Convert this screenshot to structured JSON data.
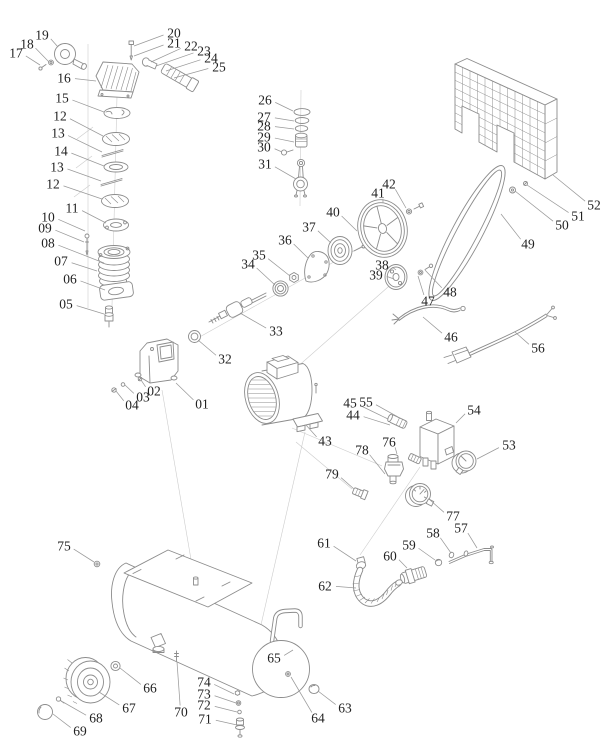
{
  "canvas": {
    "width": 615,
    "height": 755,
    "background": "#ffffff",
    "line_color": "#8c8c8c",
    "faint_line_color": "#cccccc",
    "leader_color": "#9a9a9a",
    "label_color": "#222222"
  },
  "diagram": {
    "type": "exploded-parts-diagram",
    "labels": [
      {
        "t": "01",
        "x": 202,
        "y": 404,
        "tx": 176,
        "ty": 383
      },
      {
        "t": "02",
        "x": 154,
        "y": 391,
        "tx": 141,
        "ty": 380
      },
      {
        "t": "03",
        "x": 143,
        "y": 397,
        "tx": 125,
        "ty": 385
      },
      {
        "t": "04",
        "x": 132,
        "y": 405,
        "tx": 116,
        "ty": 391
      },
      {
        "t": "05",
        "x": 66,
        "y": 304,
        "tx": 104,
        "ty": 314
      },
      {
        "t": "06",
        "x": 70,
        "y": 279,
        "tx": 105,
        "ty": 290
      },
      {
        "t": "07",
        "x": 61,
        "y": 261,
        "tx": 97,
        "ty": 271
      },
      {
        "t": "08",
        "x": 48,
        "y": 243,
        "tx": 104,
        "ty": 263
      },
      {
        "t": "09",
        "x": 45,
        "y": 228,
        "tx": 84,
        "ty": 242
      },
      {
        "t": "10",
        "x": 48,
        "y": 217,
        "tx": 85,
        "ty": 231
      },
      {
        "t": "11",
        "x": 72,
        "y": 208,
        "tx": 106,
        "ty": 223
      },
      {
        "t": "12",
        "x": 60,
        "y": 116,
        "tx": 103,
        "ty": 136
      },
      {
        "t": "13",
        "x": 58,
        "y": 133,
        "tx": 102,
        "ty": 152
      },
      {
        "t": "14",
        "x": 61,
        "y": 151,
        "tx": 104,
        "ty": 166
      },
      {
        "t": "13",
        "x": 57,
        "y": 167,
        "tx": 101,
        "ty": 181
      },
      {
        "t": "12",
        "x": 53,
        "y": 184,
        "tx": 102,
        "ty": 199
      },
      {
        "t": "15",
        "x": 62,
        "y": 98,
        "tx": 104,
        "ty": 112
      },
      {
        "t": "16",
        "x": 64,
        "y": 78,
        "tx": 96,
        "ty": 81
      },
      {
        "t": "17",
        "x": 16,
        "y": 53,
        "tx": 40,
        "ty": 65
      },
      {
        "t": "18",
        "x": 27,
        "y": 44,
        "tx": 49,
        "ty": 62
      },
      {
        "t": "19",
        "x": 42,
        "y": 35,
        "tx": 58,
        "ty": 47
      },
      {
        "t": "20",
        "x": 174,
        "y": 33,
        "tx": 134,
        "ty": 46
      },
      {
        "t": "21",
        "x": 174,
        "y": 43,
        "tx": 134,
        "ty": 56
      },
      {
        "t": "22",
        "x": 191,
        "y": 46,
        "tx": 151,
        "ty": 62
      },
      {
        "t": "23",
        "x": 204,
        "y": 51,
        "tx": 156,
        "ty": 66
      },
      {
        "t": "24",
        "x": 211,
        "y": 58,
        "tx": 166,
        "ty": 71
      },
      {
        "t": "25",
        "x": 219,
        "y": 67,
        "tx": 174,
        "ty": 78
      },
      {
        "t": "26",
        "x": 265,
        "y": 100,
        "tx": 293,
        "ty": 111
      },
      {
        "t": "27",
        "x": 264,
        "y": 117,
        "tx": 294,
        "ty": 121
      },
      {
        "t": "28",
        "x": 264,
        "y": 126,
        "tx": 294,
        "ty": 129
      },
      {
        "t": "29",
        "x": 264,
        "y": 137,
        "tx": 294,
        "ty": 142
      },
      {
        "t": "30",
        "x": 264,
        "y": 147,
        "tx": 282,
        "ty": 152
      },
      {
        "t": "31",
        "x": 265,
        "y": 164,
        "tx": 296,
        "ty": 179
      },
      {
        "t": "32",
        "x": 225,
        "y": 359,
        "tx": 198,
        "ty": 340
      },
      {
        "t": "33",
        "x": 276,
        "y": 331,
        "tx": 240,
        "ty": 313
      },
      {
        "t": "34",
        "x": 248,
        "y": 264,
        "tx": 275,
        "ty": 285
      },
      {
        "t": "35",
        "x": 259,
        "y": 255,
        "tx": 290,
        "ty": 276
      },
      {
        "t": "36",
        "x": 285,
        "y": 240,
        "tx": 308,
        "ty": 258
      },
      {
        "t": "37",
        "x": 309,
        "y": 227,
        "tx": 331,
        "ty": 243
      },
      {
        "t": "38",
        "x": 382,
        "y": 265,
        "tx": 396,
        "ty": 270
      },
      {
        "t": "39",
        "x": 376,
        "y": 275,
        "tx": 394,
        "ty": 279
      },
      {
        "t": "40",
        "x": 333,
        "y": 212,
        "tx": 357,
        "ty": 231
      },
      {
        "t": "41",
        "x": 378,
        "y": 193,
        "tx": 383,
        "ty": 203
      },
      {
        "t": "42",
        "x": 389,
        "y": 184,
        "tx": 406,
        "ty": 208
      },
      {
        "t": "43",
        "x": 325,
        "y": 441,
        "tx": 306,
        "ty": 425
      },
      {
        "t": "44",
        "x": 353,
        "y": 415,
        "tx": 390,
        "ty": 425
      },
      {
        "t": "45",
        "x": 350,
        "y": 403,
        "tx": 388,
        "ty": 419
      },
      {
        "t": "46",
        "x": 451,
        "y": 337,
        "tx": 423,
        "ty": 317
      },
      {
        "t": "47",
        "x": 428,
        "y": 301,
        "tx": 418,
        "ty": 276
      },
      {
        "t": "48",
        "x": 450,
        "y": 292,
        "tx": 425,
        "ty": 270
      },
      {
        "t": "49",
        "x": 528,
        "y": 244,
        "tx": 501,
        "ty": 214
      },
      {
        "t": "50",
        "x": 562,
        "y": 225,
        "tx": 515,
        "ty": 191
      },
      {
        "t": "51",
        "x": 578,
        "y": 216,
        "tx": 527,
        "ty": 185
      },
      {
        "t": "52",
        "x": 594,
        "y": 205,
        "tx": 553,
        "ty": 175
      },
      {
        "t": "53",
        "x": 509,
        "y": 445,
        "tx": 477,
        "ty": 459
      },
      {
        "t": "54",
        "x": 474,
        "y": 410,
        "tx": 456,
        "ty": 423
      },
      {
        "t": "55",
        "x": 366,
        "y": 402,
        "tx": 398,
        "ty": 417
      },
      {
        "t": "56",
        "x": 538,
        "y": 348,
        "tx": 515,
        "ty": 332
      },
      {
        "t": "57",
        "x": 461,
        "y": 528,
        "tx": 477,
        "ty": 548
      },
      {
        "t": "58",
        "x": 433,
        "y": 533,
        "tx": 451,
        "ty": 553
      },
      {
        "t": "59",
        "x": 409,
        "y": 545,
        "tx": 435,
        "ty": 560
      },
      {
        "t": "60",
        "x": 390,
        "y": 556,
        "tx": 407,
        "ty": 568
      },
      {
        "t": "61",
        "x": 324,
        "y": 543,
        "tx": 356,
        "ty": 561
      },
      {
        "t": "62",
        "x": 325,
        "y": 586,
        "tx": 356,
        "ty": 588
      },
      {
        "t": "63",
        "x": 345,
        "y": 708,
        "tx": 318,
        "ty": 691
      },
      {
        "t": "64",
        "x": 318,
        "y": 718,
        "tx": 291,
        "ty": 677
      },
      {
        "t": "65",
        "x": 274,
        "y": 658,
        "tx": 293,
        "ty": 650
      },
      {
        "t": "66",
        "x": 150,
        "y": 688,
        "tx": 120,
        "ty": 668
      },
      {
        "t": "67",
        "x": 129,
        "y": 708,
        "tx": 99,
        "ty": 692
      },
      {
        "t": "68",
        "x": 96,
        "y": 718,
        "tx": 63,
        "ty": 702
      },
      {
        "t": "69",
        "x": 80,
        "y": 731,
        "tx": 53,
        "ty": 714
      },
      {
        "t": "70",
        "x": 181,
        "y": 712,
        "tx": 177,
        "ty": 662
      },
      {
        "t": "71",
        "x": 205,
        "y": 719,
        "tx": 237,
        "ty": 725
      },
      {
        "t": "72",
        "x": 204,
        "y": 705,
        "tx": 237,
        "ty": 712
      },
      {
        "t": "73",
        "x": 204,
        "y": 694,
        "tx": 236,
        "ty": 703
      },
      {
        "t": "74",
        "x": 204,
        "y": 682,
        "tx": 234,
        "ty": 694
      },
      {
        "t": "75",
        "x": 64,
        "y": 546,
        "tx": 94,
        "ty": 562
      },
      {
        "t": "76",
        "x": 389,
        "y": 442,
        "tx": 397,
        "ty": 454
      },
      {
        "t": "77",
        "x": 453,
        "y": 516,
        "tx": 430,
        "ty": 500
      },
      {
        "t": "78",
        "x": 362,
        "y": 450,
        "tx": 385,
        "ty": 474
      },
      {
        "t": "79",
        "x": 332,
        "y": 474,
        "tx": 354,
        "ty": 489
      }
    ]
  }
}
